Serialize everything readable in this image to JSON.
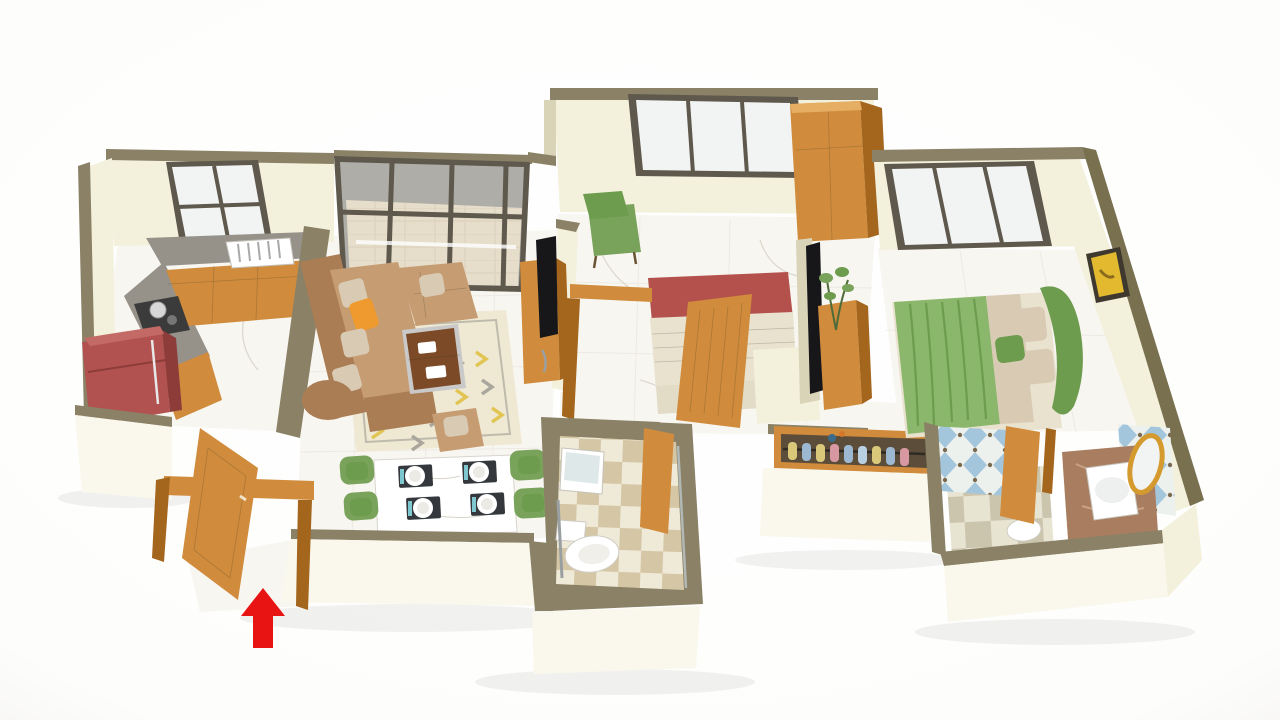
{
  "scene": {
    "type": "3d-isometric-floor-plan-render",
    "description": "3D rendered isometric cutaway floor plan of a 2 BHK apartment on a white background, cream walls with olive-brown tops, wooden doors, marble floors and a red entrance arrow at the main door",
    "background": "#fdfdfd",
    "entrance_indicator": "red-arrow-up"
  },
  "rooms": {
    "kitchen": {
      "label": "Kitchen",
      "items": [
        "refrigerator",
        "l-shaped-counter",
        "gas-stove-with-pot",
        "sink-with-dish-rack",
        "window"
      ]
    },
    "living_room": {
      "label": "Living Room",
      "items": [
        "l-shaped-sofa",
        "throw-cushions",
        "orange-accent-cushion",
        "coffee-table",
        "patterned-area-rug",
        "lounge-chair",
        "ottoman",
        "tv-unit",
        "television"
      ]
    },
    "dining": {
      "label": "Dining Area",
      "items": [
        "marble-dining-table",
        "four-green-chairs",
        "four-place-settings"
      ]
    },
    "balcony": {
      "label": "Balcony",
      "items": [
        "glass-sliding-partition",
        "tile-floor"
      ]
    },
    "entrance": {
      "label": "Entrance Foyer",
      "items": [
        "main-wooden-door",
        "door-frame",
        "red-entry-arrow"
      ]
    },
    "bedroom_1": {
      "label": "Bedroom 1",
      "items": [
        "double-bed-red",
        "green-armchair",
        "wardrobe",
        "window",
        "open-wooden-door"
      ]
    },
    "common_bathroom": {
      "label": "Common Bathroom",
      "items": [
        "toilet",
        "washbasin-with-mirror",
        "shower",
        "wooden-door",
        "checker-tile-floor"
      ]
    },
    "hallway": {
      "label": "Hallway",
      "items": [
        "shoe-rack-with-shoes"
      ]
    },
    "master_bedroom": {
      "label": "Master Bedroom",
      "items": [
        "double-bed-green",
        "curved-headboard",
        "pillows",
        "television-panel",
        "wooden-sideboard",
        "potted-plant",
        "wall-art",
        "window"
      ]
    },
    "master_bathroom": {
      "label": "Master Bathroom",
      "items": [
        "vanity-counter",
        "washbasin",
        "round-gold-mirror",
        "toilet",
        "wooden-doors",
        "blue-diamond-tile-walls",
        "checker-tile-floor"
      ]
    }
  },
  "colors": {
    "wall_top": "#8a8166",
    "wall_top_dark": "#78704f",
    "wall_face": "#f3f0dc",
    "wall_face_bright": "#faf8ec",
    "wall_face_shadow": "#d9d3b8",
    "wood": "#d08c3c",
    "wood_dark": "#a4651d",
    "wood_light": "#e6ae62",
    "frame": "#5e584d",
    "glass": "#f2f4f3",
    "marble": "#f8f6f1",
    "marble_vein": "#d9d4c9",
    "counter_gray": "#96928a",
    "fridge": "#b25250",
    "fridge_dark": "#8d3c3a",
    "sofa": "#c69c72",
    "sofa_dark": "#ab7d55",
    "cushion": "#d9cab3",
    "accent_orange": "#ee9a2f",
    "rug_base": "#efe8d3",
    "rug_yellow": "#e2c452",
    "rug_gray": "#a9a79b",
    "table_wood": "#7c4a26",
    "bed_red": "#b4514c",
    "linen": "#e9e2cf",
    "bed_green": "#8bb76d",
    "bed_green_dark": "#6d9c4e",
    "chair_green": "#79a35a",
    "tile_beige": "#d5c7a5",
    "tile_cream": "#efe9d7",
    "bath_tile_a": "#cbc5ae",
    "bath_tile_b": "#e8e4d2",
    "tile_blue": "#a3c6dc",
    "tile_dot": "#7c6a4f",
    "tile_bg": "#edf1ee",
    "balcony_tile": "#d8c19a",
    "counter_brown": "#a97e60",
    "gold": "#d49a2e",
    "black": "#17171a",
    "white": "#ffffff",
    "arrow_red": "#e81313"
  }
}
